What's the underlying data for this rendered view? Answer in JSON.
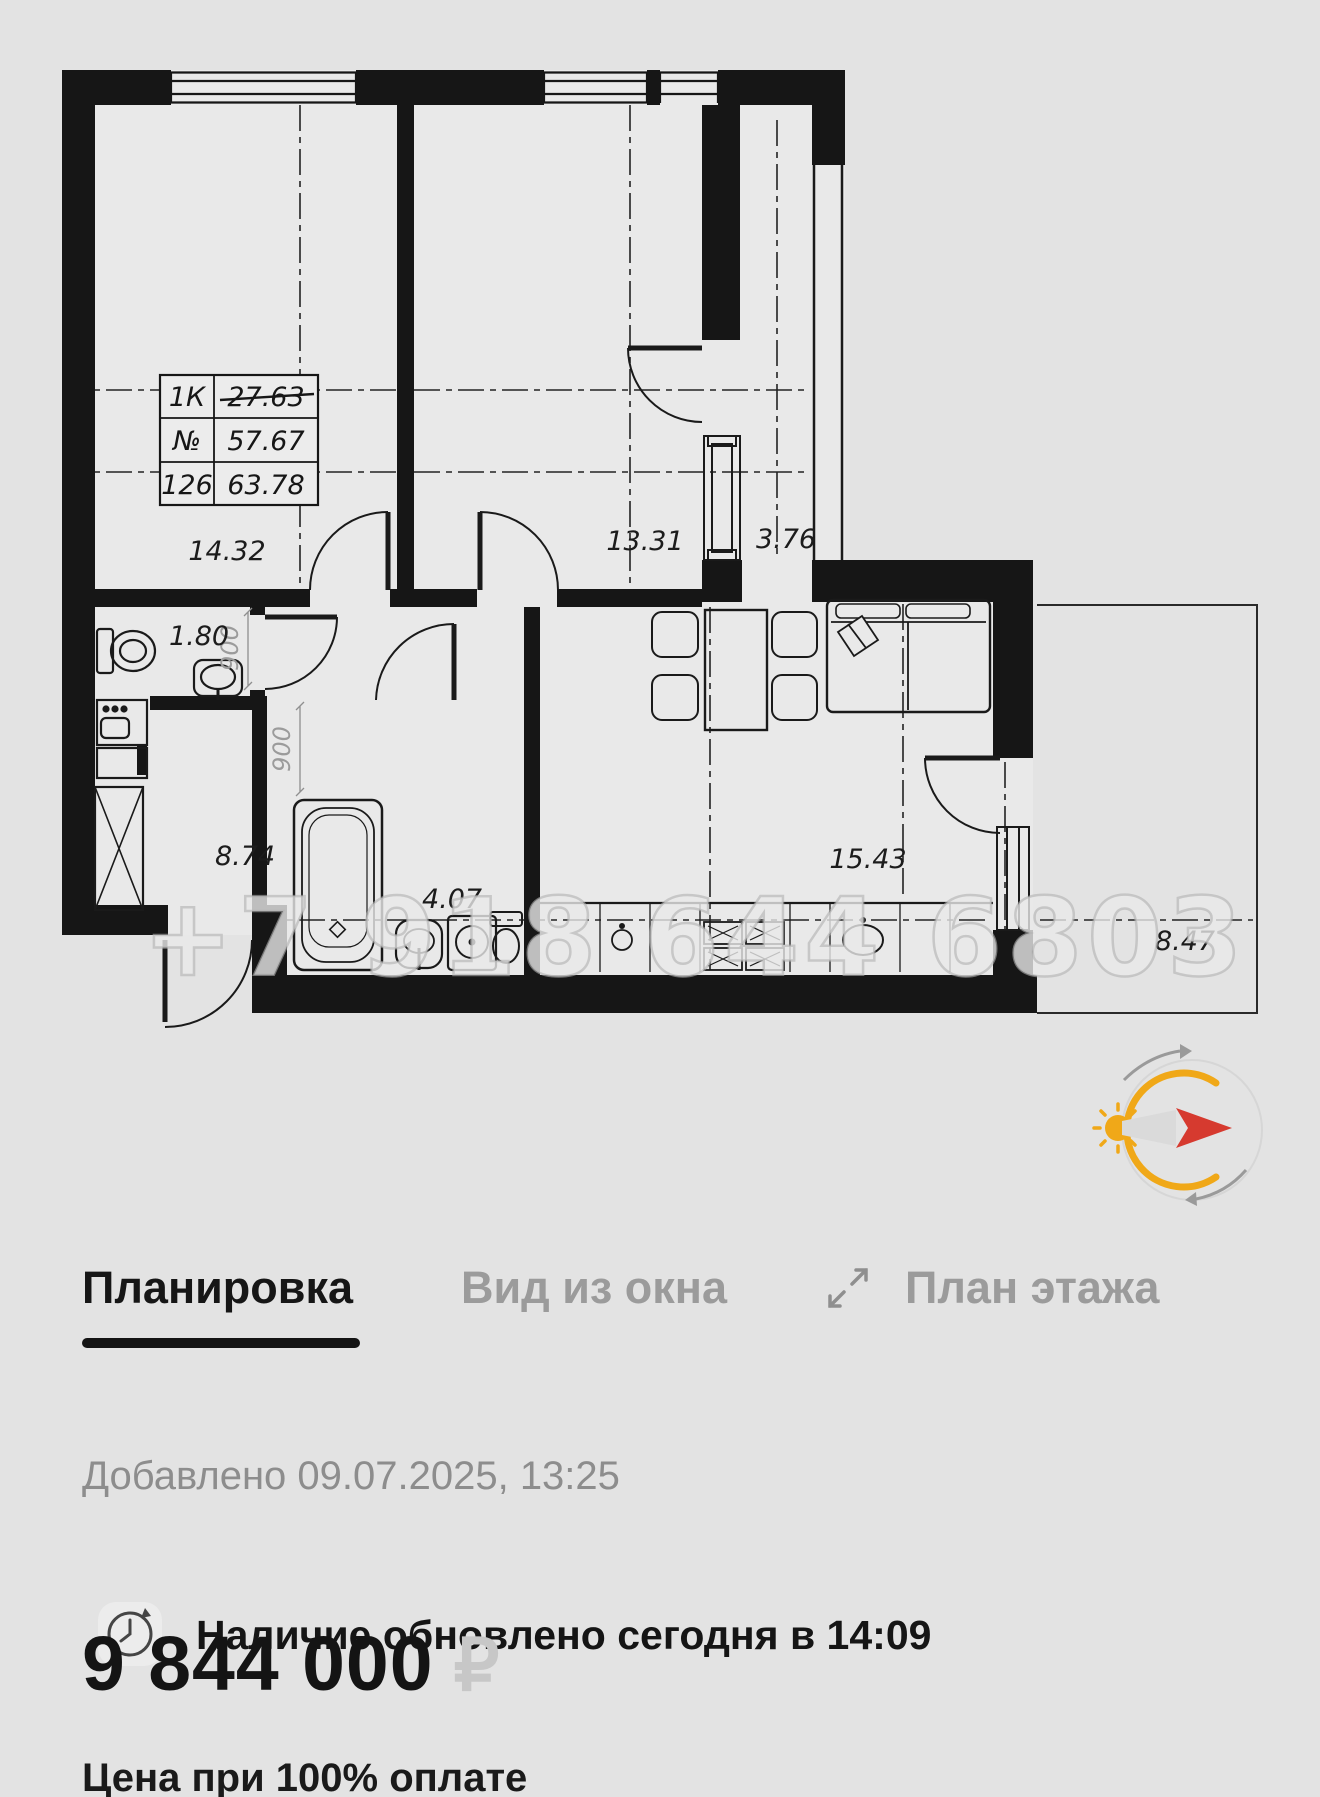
{
  "floor_plan": {
    "watermark": "+7 918 644 6803",
    "info_table": {
      "col1": [
        "1К",
        "№",
        "126"
      ],
      "col2": [
        "27.63",
        "57.67",
        "63.78"
      ],
      "strikethrough_value": "27.63"
    },
    "areas": {
      "room1": "14.32",
      "room2": "13.31",
      "corridor": "3.76",
      "wc": "1.80",
      "hall": "8.74",
      "bathroom": "4.07",
      "kitchen_living": "15.43",
      "balcony": "8.47"
    },
    "dims": {
      "d1": "900",
      "d2": "900"
    }
  },
  "compass": {
    "colors": {
      "arc": "#F0A818",
      "arrow": "#D63A2F",
      "faint": "#d6d6d6"
    }
  },
  "tabs": {
    "layout": "Планировка",
    "window_view": "Вид из окна",
    "floor_plan": "План этажа"
  },
  "meta": {
    "added": "Добавлено 09.07.2025, 13:25",
    "availability": "Наличие обновлено сегодня в 14:09"
  },
  "price": {
    "amount": "9 844 000",
    "currency_symbol": "₽",
    "note": "Цена при 100% оплате"
  },
  "colors": {
    "tab_active": "#161616",
    "tab_inactive": "#9b9b9b",
    "wall": "#161616"
  }
}
